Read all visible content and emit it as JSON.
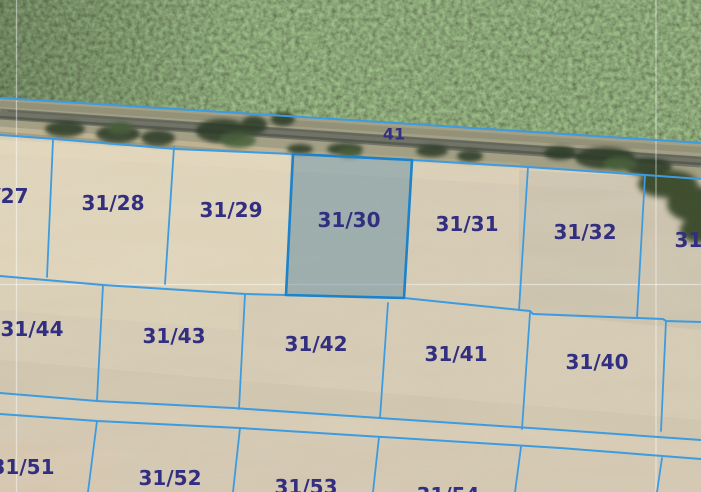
{
  "app": {
    "name": "aerial-cadastral-map-viewer",
    "view": "orthophoto-with-parcel-overlay"
  },
  "map": {
    "selected_parcel": "31/30",
    "labels": {
      "road": "41",
      "p27": "31/27",
      "p28": "31/28",
      "p29": "31/29",
      "p30": "31/30",
      "p31": "31/31",
      "p32": "31/32",
      "p33": "31/33",
      "p44": "31/44",
      "p43": "31/43",
      "p42": "31/42",
      "p41": "31/41",
      "p40": "31/40",
      "p51": "31/51",
      "p52": "31/52",
      "p53": "31/53",
      "p54": "31/54"
    },
    "colors": {
      "boundary_line": "#3d9be0",
      "selected_border": "#1b82cb",
      "selected_fill": "rgba(90,140,165,0.45)",
      "label_text": "#322e80",
      "field": "#d4c9b2",
      "forest": "#405e2e"
    }
  }
}
